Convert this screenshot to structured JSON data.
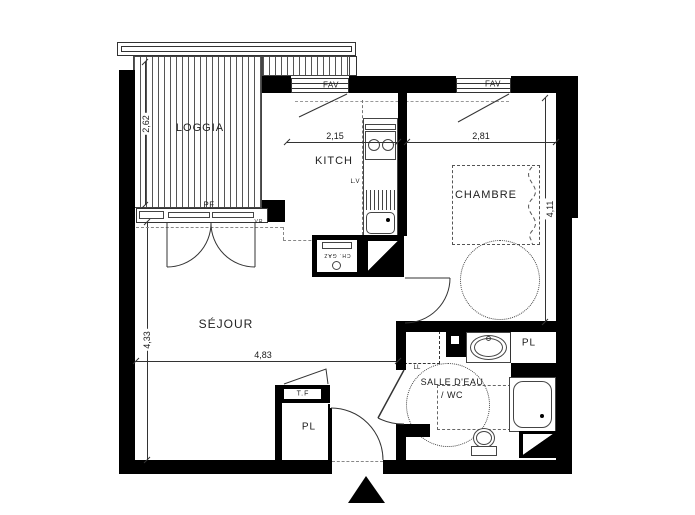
{
  "labels": {
    "loggia": "LOGGIA",
    "kitchen": "KITCH",
    "bedroom": "CHAMBRE",
    "living_room": "SÉJOUR",
    "bathroom_line1": "SALLE D'EAU",
    "bathroom_line2": "/ WC",
    "closet_bathroom": "PL",
    "closet_entry": "PL",
    "french_door": "PF",
    "window_kitchen": "FAV",
    "window_bedroom": "FAV",
    "dishwasher": "L.V",
    "washing_machine": "LL",
    "electrical_panel": "T.F",
    "roller_shutter": "VR",
    "gas_boiler": "CH. GAZ"
  },
  "dimensions": {
    "loggia_height_m": "2,62",
    "kitchen_width_m": "2,15",
    "bedroom_width_m": "2,81",
    "bedroom_height_m": "4,11",
    "living_height_m": "4,33",
    "living_width_m": "4,83"
  },
  "colors": {
    "wall": "#000000",
    "line": "#333333",
    "dashed_line": "#888888",
    "background": "#ffffff"
  }
}
